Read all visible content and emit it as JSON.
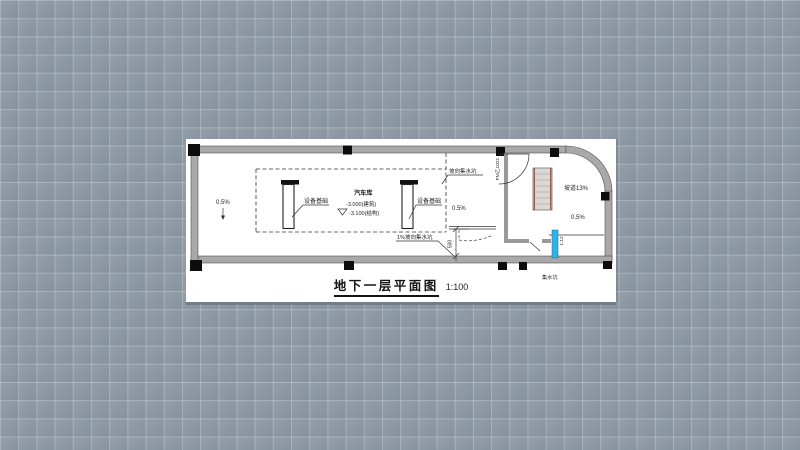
{
  "canvas": {
    "background_color": "#8e9aa4",
    "grid_line_color": "#a5b0b9",
    "grid_size_px": 18
  },
  "sheet": {
    "background_color": "#ffffff",
    "title": {
      "text": "地下一层平面图",
      "scale": "1:100"
    }
  },
  "plan": {
    "colors": {
      "wall_fill": "#a9a9a9",
      "wall_edge": "#4f4f4f",
      "column_fill": "#0d0d0d",
      "line": "#333333",
      "stair_fill": "#dbd7d2",
      "stair_stringer_red": "#8c3b2e",
      "sump_door_cyan": "#2fb3e6"
    },
    "labels": {
      "room_name": "汽车库",
      "elevation_architectural": "-3.000(建筑)",
      "elevation_structural": "-3.100(结构)",
      "slope_left": "0.5%",
      "slope_middle": "0.5%",
      "slope_ramp_area": "0.5%",
      "ramp_slope": "坡道13%",
      "ramp_grade": "1:12",
      "equipment_base_left": "设备基础",
      "equipment_base_right": "设备基础",
      "slope_to_sump": "坡向集水坑",
      "drain_to_sump": "1%坡向集水坑",
      "sump_pit": "集水坑",
      "fire_door": "FM乙1021",
      "dim_500": "500"
    }
  }
}
